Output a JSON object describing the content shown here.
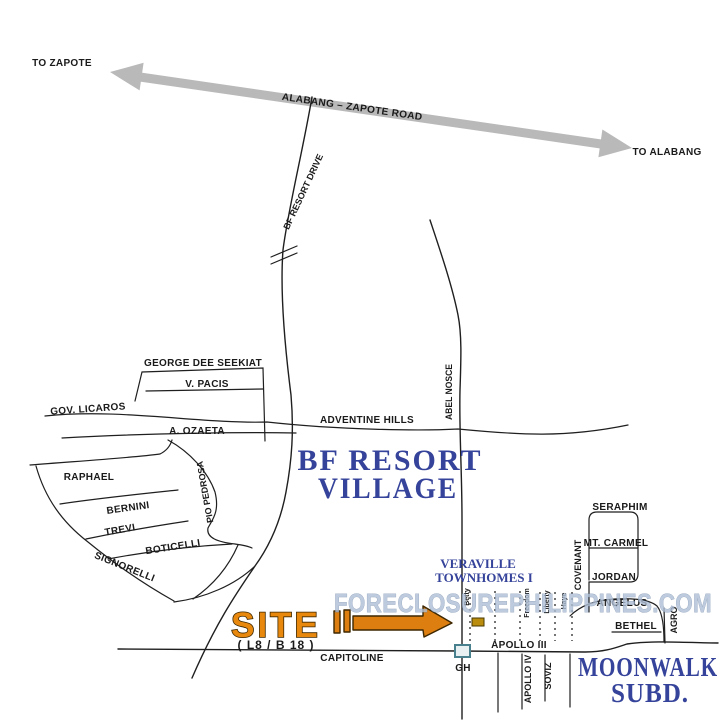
{
  "map_type": "vicinity-sketch-map",
  "labels": {
    "to_zapote": "TO ZAPOTE",
    "to_alabang": "TO ALABANG",
    "alabang_zapote_road": "ALABANG – ZAPOTE ROAD",
    "bf_resort_drive": "BF RESORT DRIVE",
    "george_dee_seekiat": "GEORGE DEE SEEKIAT",
    "v_pacis": "V. PACIS",
    "gov_licaros": "GOV. LICAROS",
    "a_ozaeta": "A. OZAETA",
    "adventine_hills": "ADVENTINE HILLS",
    "raphael": "RAPHAEL",
    "bernini": "BERNINI",
    "trevi": "TREVI",
    "boticelli": "BOTICELLI",
    "signorelli": "SIGNORELLI",
    "pio_pedrosa": "PIO PEDROSA",
    "abel_nosce": "ABEL NOSCE",
    "bf_resort_village_line1": "BF RESORT",
    "bf_resort_village_line2": "VILLAGE",
    "veraville_line1": "VERAVILLE",
    "veraville_line2": "TOWNHOMES I",
    "seraphim": "SERAPHIM",
    "mt_carmel": "MT. CARMEL",
    "jordan": "JORDAN",
    "covenant": "COVENANT",
    "angelus": "ANGELUS",
    "bethel": "BETHEL",
    "agro": "AGRO",
    "street_betty": "Betty",
    "street_freedom": "Freedom",
    "street_liberty": "Liberty",
    "street_haye": "Haye",
    "site": "SITE",
    "site_lot_block": "( L8 / B 18 )",
    "capitoline": "CAPITOLINE",
    "gatehouse": "GH",
    "apollo_iii": "APOLLO III",
    "apollo_iv": "APOLLO IV",
    "soviz": "SOVIZ",
    "moonwalk_line1": "MOONWALK",
    "moonwalk_line2": "SUBD."
  },
  "watermark": "FORECLOSUREPHILIPPINES.COM",
  "colors": {
    "background": "#ffffff",
    "road_line": "#1f1f1f",
    "highway_gray": "#b9b9b9",
    "area_name_navy": "#35439a",
    "site_orange": "#e8890e",
    "arrow_orange": "#dd7f10",
    "watermark_blue": "#aebfd6",
    "gatehouse_box_teal": "#48808e",
    "site_block_marker": "#bb8d0e"
  }
}
